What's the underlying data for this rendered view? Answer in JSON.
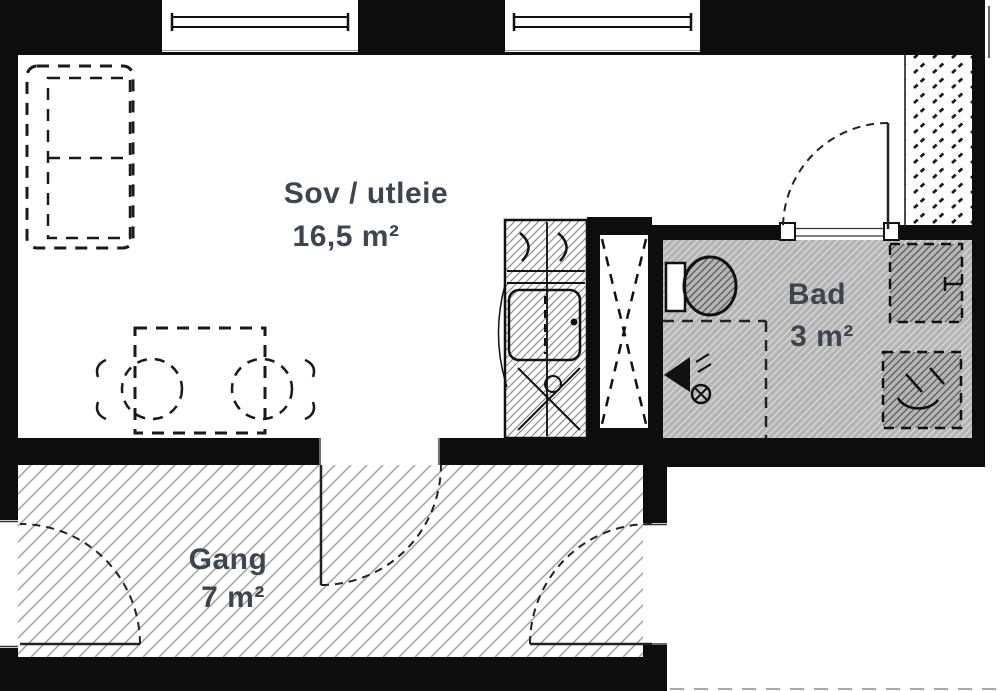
{
  "rooms": [
    {
      "name": "Sov / utleie",
      "area": "16,5 m²"
    },
    {
      "name": "Bad",
      "area": "3 m²"
    },
    {
      "name": "Gang",
      "area": "7 m²"
    }
  ],
  "colors": {
    "wall": "#0d0d0d",
    "bath_floor": "#b5b5b5",
    "label_text": "#3d4650",
    "hatch": "#9a9a9a"
  }
}
